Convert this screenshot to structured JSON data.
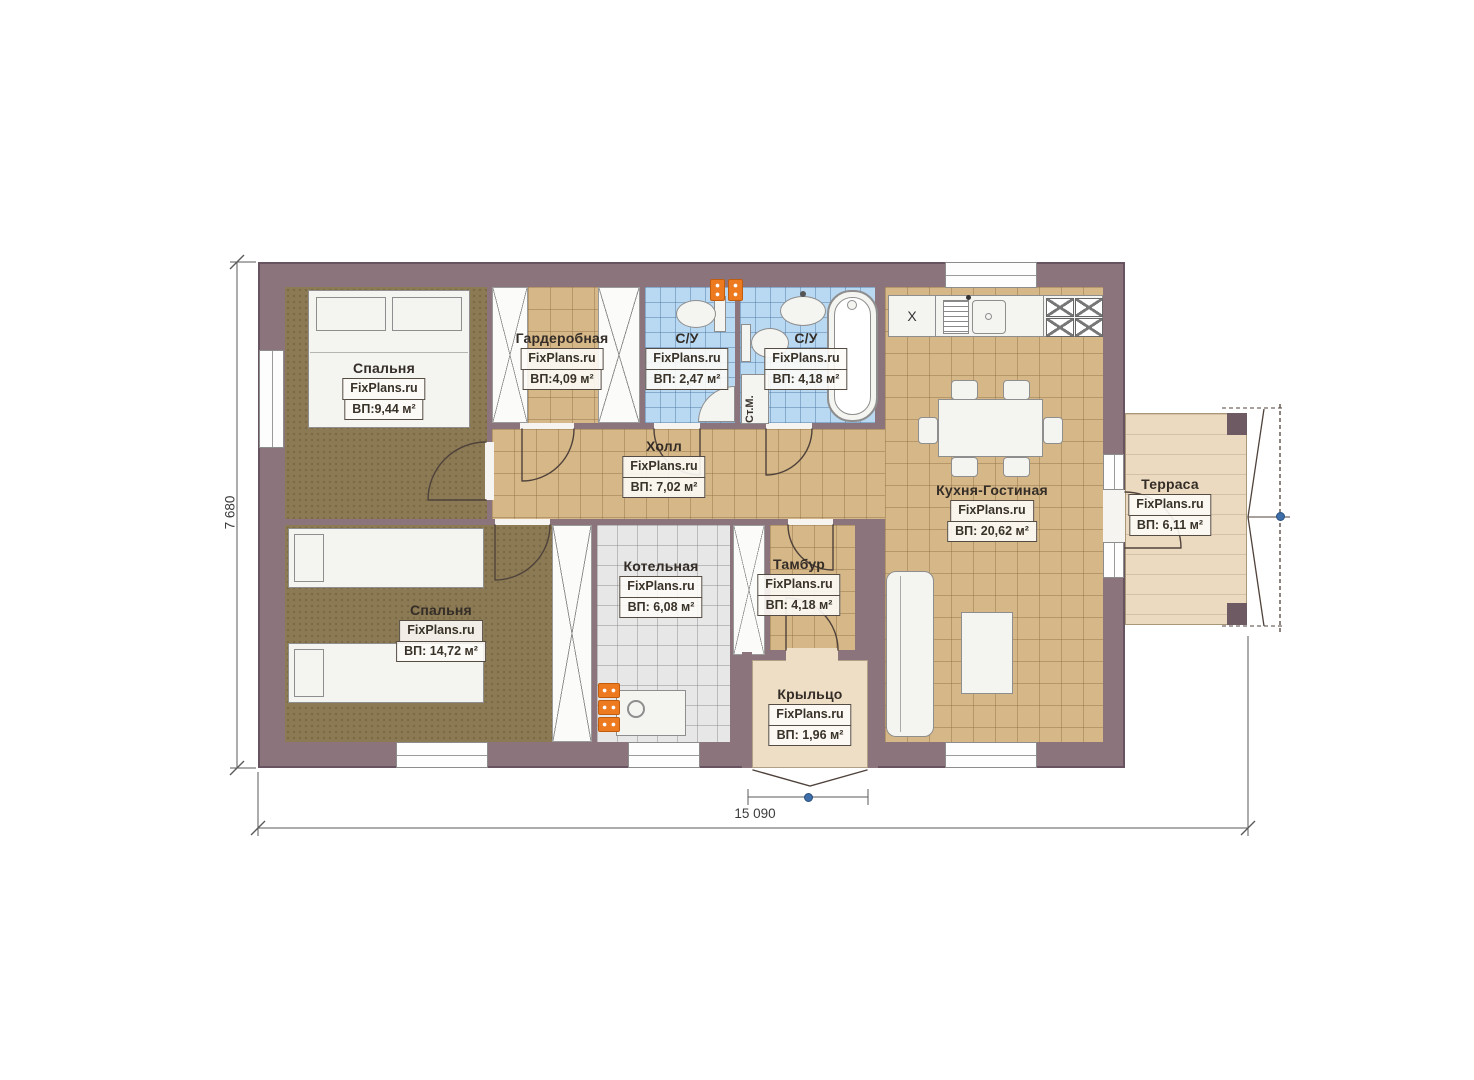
{
  "brand": "FixPlans.ru",
  "rooms": [
    {
      "name": "Спальня",
      "area": "ВП:9,44 м²"
    },
    {
      "name": "Гардеробная",
      "area": "ВП:4,09 м²"
    },
    {
      "name": "С/У",
      "area": "ВП: 2,47 м²"
    },
    {
      "name": "С/У",
      "area": "ВП: 4,18 м²"
    },
    {
      "name": "Холл",
      "area": "ВП: 7,02 м²"
    },
    {
      "name": "Кухня-Гостиная",
      "area": "ВП: 20,62 м²"
    },
    {
      "name": "Терраса",
      "area": "ВП: 6,11 м²"
    },
    {
      "name": "Спальня",
      "area": "ВП: 14,72 м²"
    },
    {
      "name": "Котельная",
      "area": "ВП: 6,08 м²"
    },
    {
      "name": "Тамбур",
      "area": "ВП: 4,18 м²"
    },
    {
      "name": "Крыльцо",
      "area": "ВП: 1,96 м²"
    }
  ],
  "dimensions": {
    "overall_width": "15 090",
    "overall_height": "7 680"
  },
  "fixtures": {
    "washing_machine": "Ст.М.",
    "kitchen_cabinet": "X"
  },
  "colors": {
    "wall": "#8c747c",
    "bedroom_floor": "#8c7a54",
    "tile_floor": "#d6b787",
    "bath_tile": "#b9d9f3",
    "boiler_tile": "#e7e7e7",
    "terrace_floor": "#ebdac0",
    "radiator_orange": "#ee7a20",
    "handle_blue": "#3d6ea9"
  }
}
